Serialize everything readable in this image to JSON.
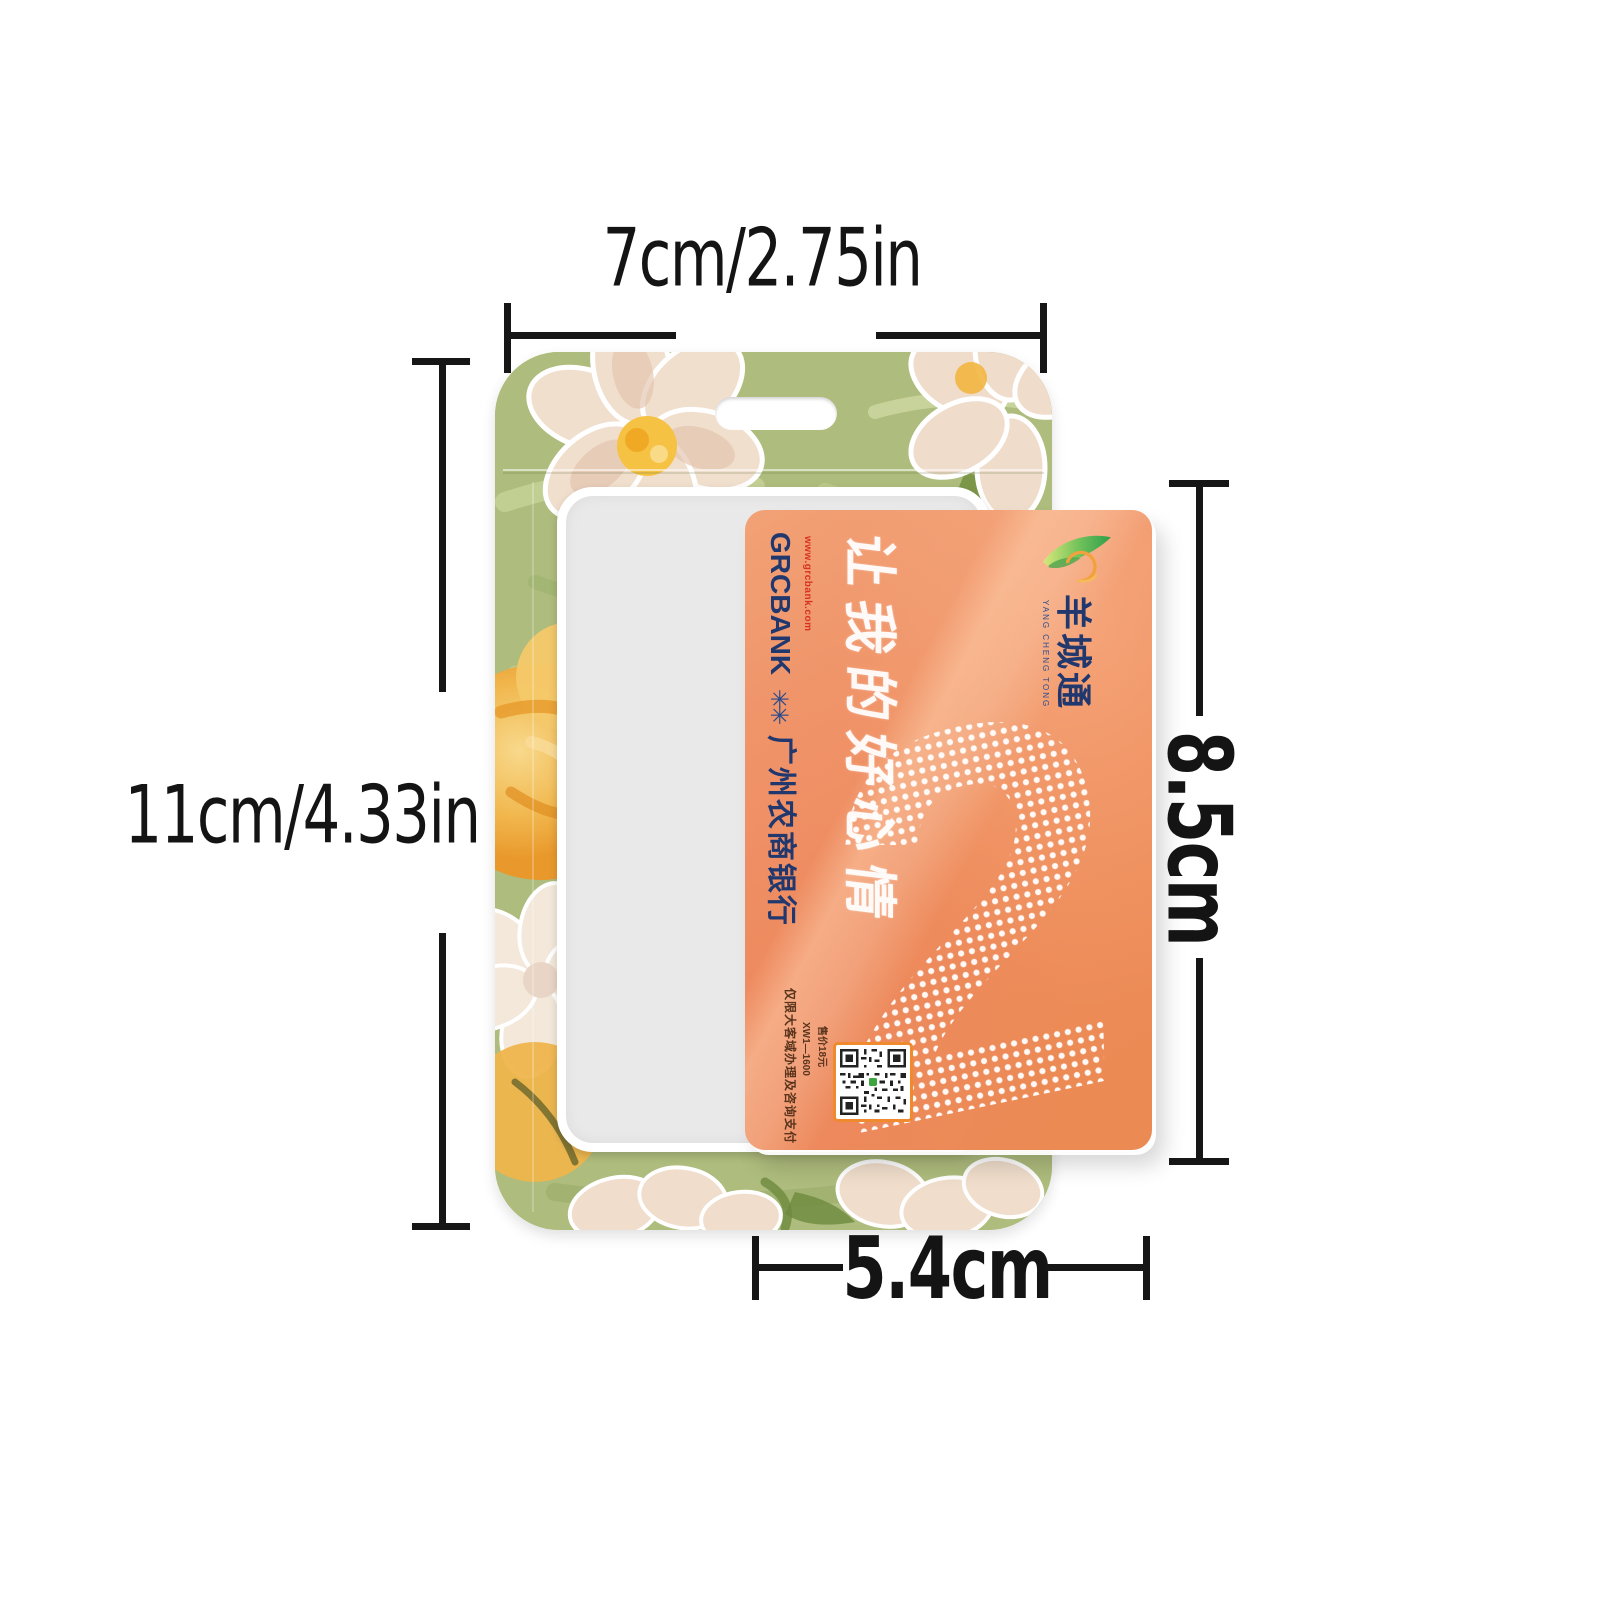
{
  "annotations": {
    "holder_width_label": "7cm/2.75in",
    "holder_height_label": "11cm/4.33in",
    "card_height_label": "8.5cm",
    "card_width_label": "5.4cm",
    "line_color": "#161616"
  },
  "holder": {
    "description": "oil-painting floral badge holder with hanging slot and clear window",
    "colors": {
      "base_green": "#aebc7d",
      "window_gray": "#e9e9ea",
      "flower_cream": "#f1dfcd",
      "flower_yellow": "#f1b84f"
    }
  },
  "card": {
    "brand_cn": "羊城通",
    "brand_en": "YANG CHENG TONG",
    "bank_en": "GRCBANK",
    "bank_url": "www.grcbank.com",
    "bank_cn": "广州农商银行",
    "slogan": "让我的好心情",
    "big_numeral": "2",
    "fineprint_notice": "仅限大客域办理及咨询支付",
    "fineprint_model": "XW1—1600",
    "fineprint_price": "售价18元",
    "colors": {
      "base_orange": "#ee8f5d",
      "navy": "#21386f",
      "red": "#d5321f",
      "qr_border": "#ef8a2e",
      "qr_green": "#3fa53f"
    }
  },
  "icons": {
    "bank_logo_glyph": "✳✳",
    "brand_logo": "leaf-swirl-icon"
  }
}
